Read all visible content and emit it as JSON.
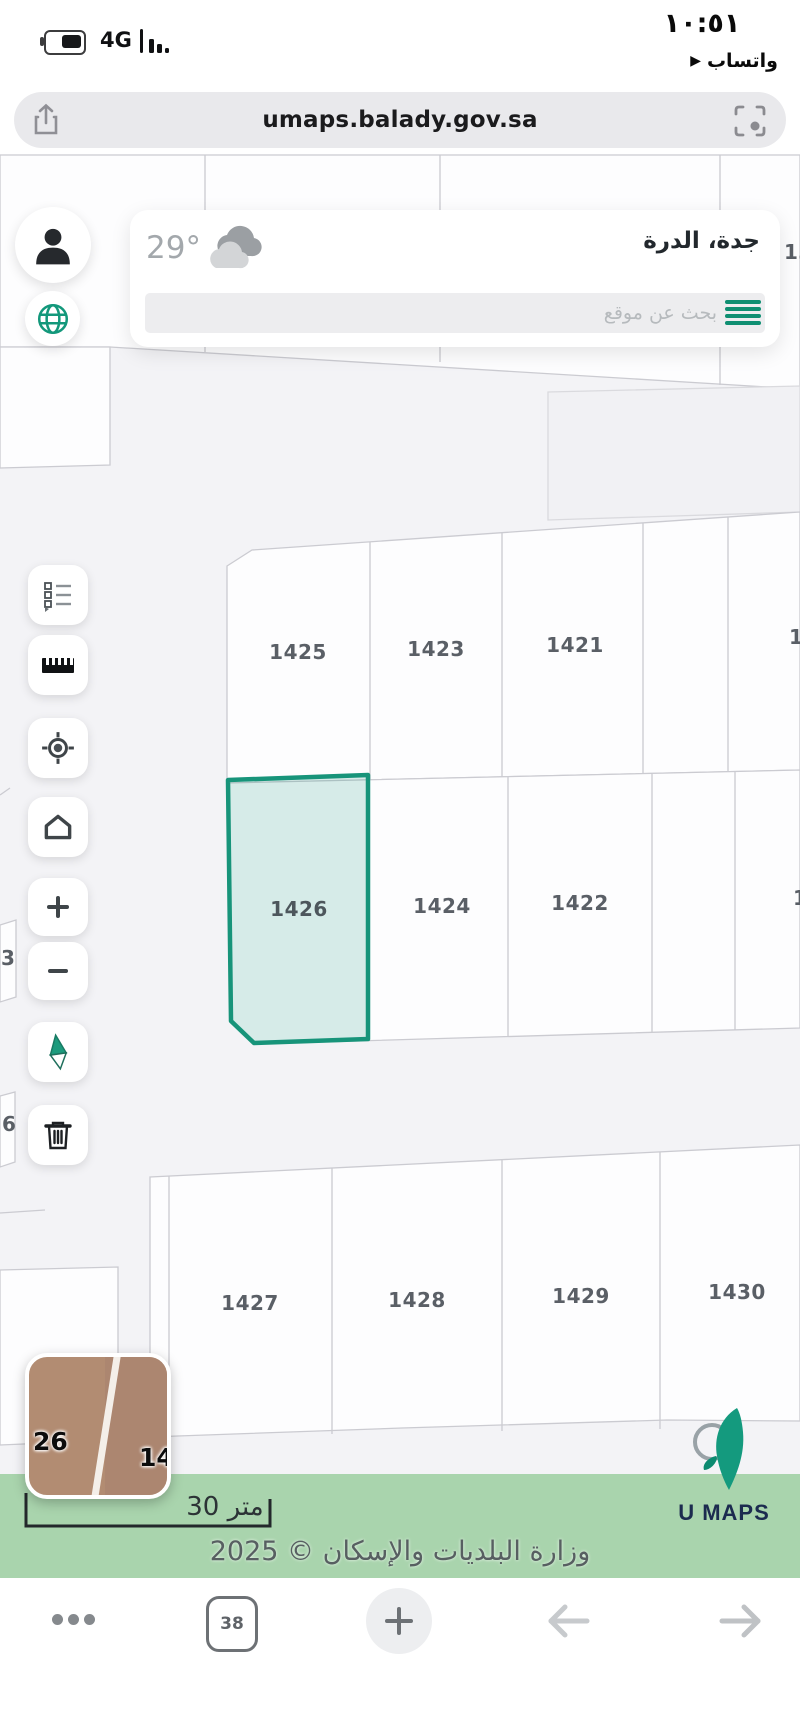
{
  "status_bar": {
    "time": "١٠:٥١",
    "network": "4G",
    "return_app": {
      "arrow": "▶",
      "label": "واتساب"
    }
  },
  "url_bar": {
    "url": "umaps.balady.gov.sa"
  },
  "header": {
    "location": "جدة، الدرة",
    "temperature": "29°",
    "search_placeholder": "بحث عن موقع"
  },
  "map_toolbar": {
    "buttons": [
      "layers-legend",
      "ruler",
      "locate",
      "home",
      "zoom-in",
      "zoom-out",
      "compass",
      "delete"
    ]
  },
  "map": {
    "accent_color": "#17947a",
    "highlight_fill": "#d7efe7",
    "parcels": [
      {
        "label": "1425",
        "x": 298,
        "y": 652
      },
      {
        "label": "1423",
        "x": 436,
        "y": 649
      },
      {
        "label": "1421",
        "x": 575,
        "y": 645
      },
      {
        "label": "1426",
        "x": 299,
        "y": 909,
        "highlighted": true
      },
      {
        "label": "1424",
        "x": 442,
        "y": 906
      },
      {
        "label": "1422",
        "x": 580,
        "y": 903
      },
      {
        "label": "1427",
        "x": 250,
        "y": 1303
      },
      {
        "label": "1428",
        "x": 417,
        "y": 1300
      },
      {
        "label": "1429",
        "x": 581,
        "y": 1296
      },
      {
        "label": "1430",
        "x": 737,
        "y": 1292
      }
    ],
    "partial_labels": [
      {
        "label": "13",
        "x": 784,
        "y": 252
      },
      {
        "label": "1",
        "x": 789,
        "y": 637
      },
      {
        "label": "1",
        "x": 793,
        "y": 898
      },
      {
        "label": "3",
        "x": 1,
        "y": 958
      },
      {
        "label": "6",
        "x": 2,
        "y": 1124
      }
    ],
    "overview_thumbnail": {
      "labels": {
        "left": "26",
        "right": "14"
      }
    },
    "scale_bar": {
      "label": "30 متر"
    }
  },
  "footer": {
    "copyright": "وزارة البلديات والإسكان © 2025",
    "logo_text": "U MAPS",
    "band_color": "#a9d4ad"
  },
  "browser_toolbar": {
    "tabs_count": "38"
  }
}
